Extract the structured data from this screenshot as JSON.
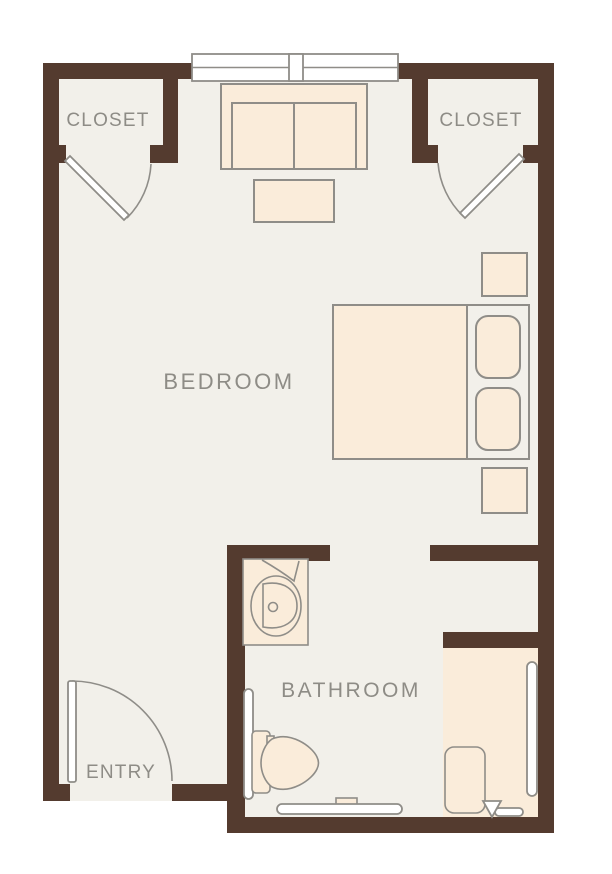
{
  "plan_title": "Studio floor plan",
  "rooms": {
    "closet_left": {
      "label": "CLOSET"
    },
    "closet_right": {
      "label": "CLOSET"
    },
    "bedroom": {
      "label": "BEDROOM"
    },
    "bathroom": {
      "label": "BATHROOM"
    },
    "entry": {
      "label": "ENTRY"
    }
  },
  "fixtures": [
    "double-window",
    "sofa",
    "coffee-table",
    "bed",
    "headboard",
    "pillow",
    "pillow",
    "nightstand",
    "nightstand",
    "closet-door-swing",
    "closet-door-swing",
    "entry-door-swing",
    "sink-vanity",
    "faucet",
    "toilet",
    "grab-bar",
    "grab-bar",
    "grab-bar",
    "shower",
    "shower-bench",
    "shower-drain"
  ],
  "colors": {
    "wall": "#543b2f",
    "floor": "#f2f0ea",
    "furniture": "#faecda",
    "outline": "#8f8d88",
    "fixture": "#ffffff",
    "label": "#8e8c86",
    "background": "#ffffff"
  }
}
